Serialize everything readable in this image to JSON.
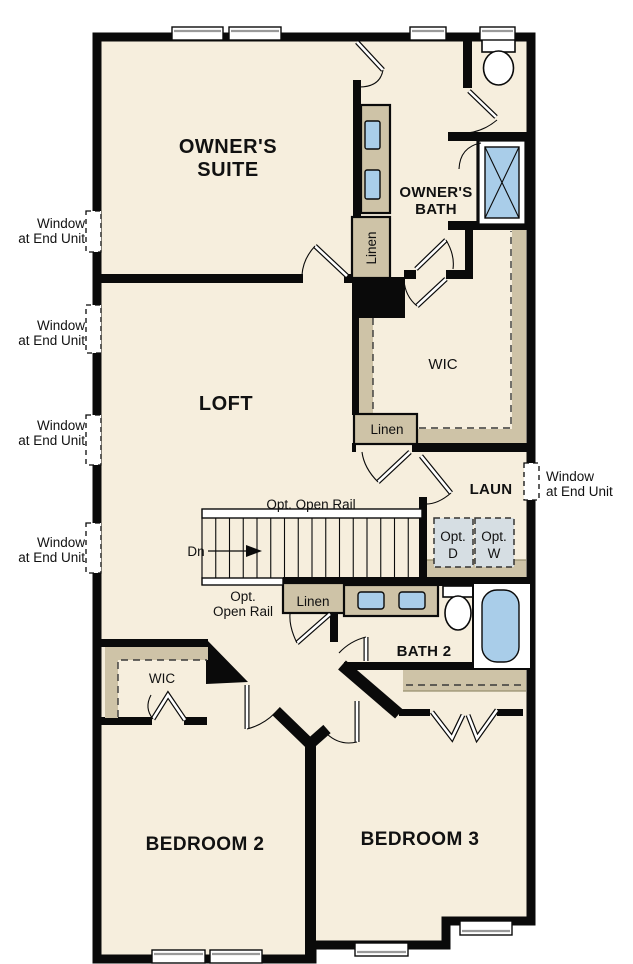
{
  "plan": {
    "type": "floor-plan",
    "colors": {
      "floor": "#f6eedd",
      "wall": "#0a0a0a",
      "cabinet": "#cec3a7",
      "fixture": "#a9cde9",
      "appliance": "#d6dee3"
    },
    "rooms": {
      "owners_suite_l1": "OWNER'S",
      "owners_suite_l2": "SUITE",
      "owners_bath_l1": "OWNER'S",
      "owners_bath_l2": "BATH",
      "loft": "LOFT",
      "wic_upper": "WIC",
      "laundry": "LAUN",
      "bath2": "BATH 2",
      "wic_lower": "WIC",
      "bedroom2": "BEDROOM 2",
      "bedroom3": "BEDROOM 3"
    },
    "labels": {
      "linen": "Linen",
      "down": "Dn",
      "open_rail": "Opt. Open Rail",
      "open_rail_l1": "Opt.",
      "open_rail_l2": "Open Rail",
      "window_note_l1": "Window",
      "window_note_l2": "at End Unit",
      "opt": "Opt.",
      "dryer": "D",
      "washer": "W"
    }
  }
}
